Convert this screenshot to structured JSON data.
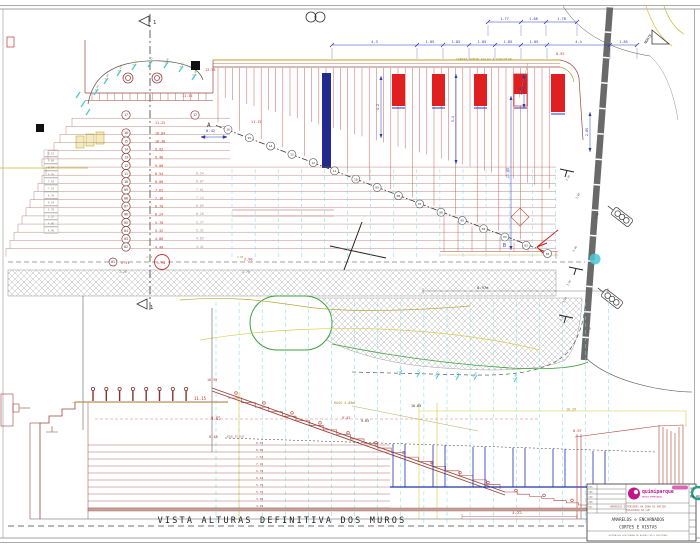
{
  "view_title": "VISTA ALTURAS DEFINITIVA DOS MUROS",
  "plan": {
    "note": {
      "t": "CONTRA FORTE FALSO A EXECUTAR",
      "x": 456,
      "y": 60.5
    },
    "labels": [
      {
        "t": "12.55",
        "x": 205,
        "y": 71,
        "c": "red",
        "s": 3.5
      },
      {
        "t": "11.15",
        "x": 182,
        "y": 97,
        "c": "red",
        "s": 3.5
      },
      {
        "t": "11.15",
        "x": 251,
        "y": 123,
        "c": "red",
        "s": 3.5
      },
      {
        "t": "8.92",
        "x": 556,
        "y": 55,
        "c": "red",
        "s": 3.5
      },
      {
        "t": "0.42",
        "x": 206,
        "y": 132,
        "c": "blue",
        "s": 3.8
      },
      {
        "t": "A",
        "x": 207,
        "y": 127,
        "c": "dark",
        "s": 6
      },
      {
        "t": "B",
        "x": 503,
        "y": 247,
        "c": "blue",
        "s": 5
      },
      {
        "t": "8.97m",
        "x": 477,
        "y": 289,
        "c": "dark",
        "s": 3.8
      },
      {
        "t": "2.91",
        "x": 121,
        "y": 264,
        "c": "red",
        "s": 3.5
      },
      {
        "t": "3.94",
        "x": 156.5,
        "y": 263.8,
        "c": "red",
        "s": 3.6
      },
      {
        "t": "2.90",
        "x": 244,
        "y": 260.5,
        "c": "red",
        "s": 3.5
      },
      {
        "t": "3.26",
        "x": 119,
        "y": 273,
        "c": "gray2",
        "s": 3.2
      },
      {
        "t": "3.79",
        "x": 242,
        "y": 273,
        "c": "gray2",
        "s": 3.2
      },
      {
        "t": "4.05",
        "x": 146,
        "y": 258,
        "c": "olive",
        "s": 2.6
      },
      {
        "t": "4.05",
        "x": 237,
        "y": 258,
        "c": "olive",
        "s": 2.6
      },
      {
        "t": "1",
        "x": 153,
        "y": 24,
        "c": "dark",
        "s": 5.5
      },
      {
        "t": "1",
        "x": 150,
        "y": 309,
        "c": "dark",
        "s": 5.5
      }
    ],
    "north_label": "NORTE",
    "steps_top": {
      "n": "17",
      "v": "11.25"
    },
    "steps_column": [
      {
        "n": "16",
        "v": "10.84"
      },
      {
        "n": "15",
        "v": "10.38"
      },
      {
        "n": "14",
        "v": "9.92"
      },
      {
        "n": "13",
        "v": "9.46"
      },
      {
        "n": "12",
        "v": "9.00"
      },
      {
        "n": "11",
        "v": "8.54"
      },
      {
        "n": "10",
        "v": "8.08"
      },
      {
        "n": "09",
        "v": "7.62"
      },
      {
        "n": "08",
        "v": "7.16"
      },
      {
        "n": "07",
        "v": "6.70"
      },
      {
        "n": "06",
        "v": "6.24"
      },
      {
        "n": "05",
        "v": "5.78"
      },
      {
        "n": "04",
        "v": "5.32"
      },
      {
        "n": "03",
        "v": "4.86"
      },
      {
        "n": "02",
        "v": "4.40"
      }
    ],
    "ghost_values": [
      "8.54",
      "8.07",
      "7.61",
      "7.14",
      "6.69",
      "6.26",
      "5.77",
      "5.31",
      "4.85",
      "4.41"
    ],
    "bottom_row": {
      "n": "01",
      "v": "2.91"
    },
    "left_stack": [
      "9.23",
      "9.00",
      "8.54",
      "8.08",
      "7.62",
      "7.16",
      "6.70",
      "6.24",
      "5.78",
      "5.32",
      "4.86",
      "4.40"
    ],
    "diagonal_steps": [
      "16",
      "15",
      "14",
      "13",
      "12",
      "11",
      "10",
      "09",
      "08",
      "07",
      "06",
      "05",
      "04",
      "03",
      "02",
      "01"
    ],
    "dims_top": {
      "nodes": [
        488,
        521,
        546,
        577
      ],
      "labels": [
        "1.77",
        "1.68",
        "1.78"
      ],
      "y": 22
    },
    "dims_main": {
      "nodes": [
        332,
        417,
        443,
        469,
        495,
        521,
        547,
        610,
        637
      ],
      "labels": [
        "4.3",
        "1.85",
        "1.85",
        "1.85",
        "1.85",
        "1.85",
        "4.4",
        "1.85"
      ],
      "y": 45
    },
    "vdims": [
      {
        "v": "4.2",
        "x": 381,
        "y1": 76,
        "y2": 138
      },
      {
        "v": "5.4",
        "x": 456,
        "y1": 74,
        "y2": 164
      },
      {
        "v": "2.48",
        "x": 524,
        "y1": 74,
        "y2": 108
      },
      {
        "v": "11.05",
        "x": 511,
        "y1": 96,
        "y2": 250
      },
      {
        "v": "2.89",
        "x": 590,
        "y1": 112,
        "y2": 152
      }
    ],
    "curve_spots": [
      [
        "9.06",
        96,
        91
      ],
      [
        "9.08",
        106,
        80
      ],
      [
        "9.10",
        119,
        72
      ],
      [
        "9.12",
        134,
        66
      ],
      [
        "9.11",
        150,
        63
      ],
      [
        "9.09",
        166,
        64
      ],
      [
        "9.07",
        181,
        68
      ],
      [
        "9.05",
        194,
        76
      ]
    ],
    "road_spots": [
      [
        "3.46",
        567,
        181
      ],
      [
        "3.49",
        577,
        199
      ],
      [
        "3.39",
        596,
        219
      ],
      [
        "3.36",
        574,
        252
      ],
      [
        "3.45",
        568,
        286
      ],
      [
        "3.43",
        564,
        303
      ],
      [
        "3.42",
        561,
        321
      ],
      [
        "3.41",
        588,
        333
      ]
    ],
    "line_spots": [
      [
        "3.44",
        399,
        373
      ],
      [
        "3.43",
        417,
        375
      ],
      [
        "3.42",
        436,
        377
      ],
      [
        "3.41",
        456,
        378
      ],
      [
        "3.40",
        474,
        378
      ],
      [
        "3.39",
        514,
        380
      ]
    ]
  },
  "elevation": {
    "labels": [
      {
        "t": "11.15",
        "x": 194,
        "y": 400,
        "c": "red",
        "s": 4
      },
      {
        "t": "10.59",
        "x": 207,
        "y": 381,
        "c": "red",
        "s": 3.4
      },
      {
        "t": "9.65",
        "x": 211,
        "y": 420,
        "c": "red",
        "s": 4
      },
      {
        "t": "9.48",
        "x": 209,
        "y": 438,
        "c": "red",
        "s": 3.6
      },
      {
        "t": "NIVEL DO CAIS",
        "x": 227,
        "y": 437.5,
        "c": "dred",
        "s": 2.2
      },
      {
        "t": "RASG 4.08m",
        "x": 334,
        "y": 404,
        "c": "olive",
        "s": 3.4
      },
      {
        "t": "9.43",
        "x": 342,
        "y": 419,
        "c": "red",
        "s": 3.4
      },
      {
        "t": "9.65",
        "x": 361,
        "y": 422,
        "c": "dark",
        "s": 3.4
      },
      {
        "t": "10.65",
        "x": 411,
        "y": 407,
        "c": "dark",
        "s": 3.4
      },
      {
        "t": "10.29",
        "x": 566,
        "y": 410.5,
        "c": "olive",
        "s": 3.4
      },
      {
        "t": "8.97",
        "x": 573,
        "y": 432,
        "c": "red",
        "s": 3.6
      },
      {
        "t": "3.55",
        "x": 512,
        "y": 514,
        "c": "red",
        "s": 4
      }
    ],
    "course_values": [
      "8.54",
      "8.08",
      "7.62",
      "7.16",
      "6.70",
      "6.24",
      "5.78",
      "5.32",
      "4.86",
      "4.40"
    ]
  },
  "titleblock": {
    "company": "quimiparque",
    "company_sub": "PARQUE EMPRESARIAL",
    "project1": "ARRANJOS EXTERIORES NA ZONA DO ANTIGO",
    "project2": "ESTALEIRO DA CUF",
    "subject1": "AMARELOS e ENCARNADOS",
    "subject2": "CORTES E VISTAS",
    "note": "ALTERACOES EFECTUADAS DE ACORDO COM O EXECUTADO",
    "number_label": "Nº",
    "number": "0q-AE0",
    "rows": [
      "DES.",
      "VER.",
      "COP.",
      "APR.",
      "ESC."
    ]
  }
}
